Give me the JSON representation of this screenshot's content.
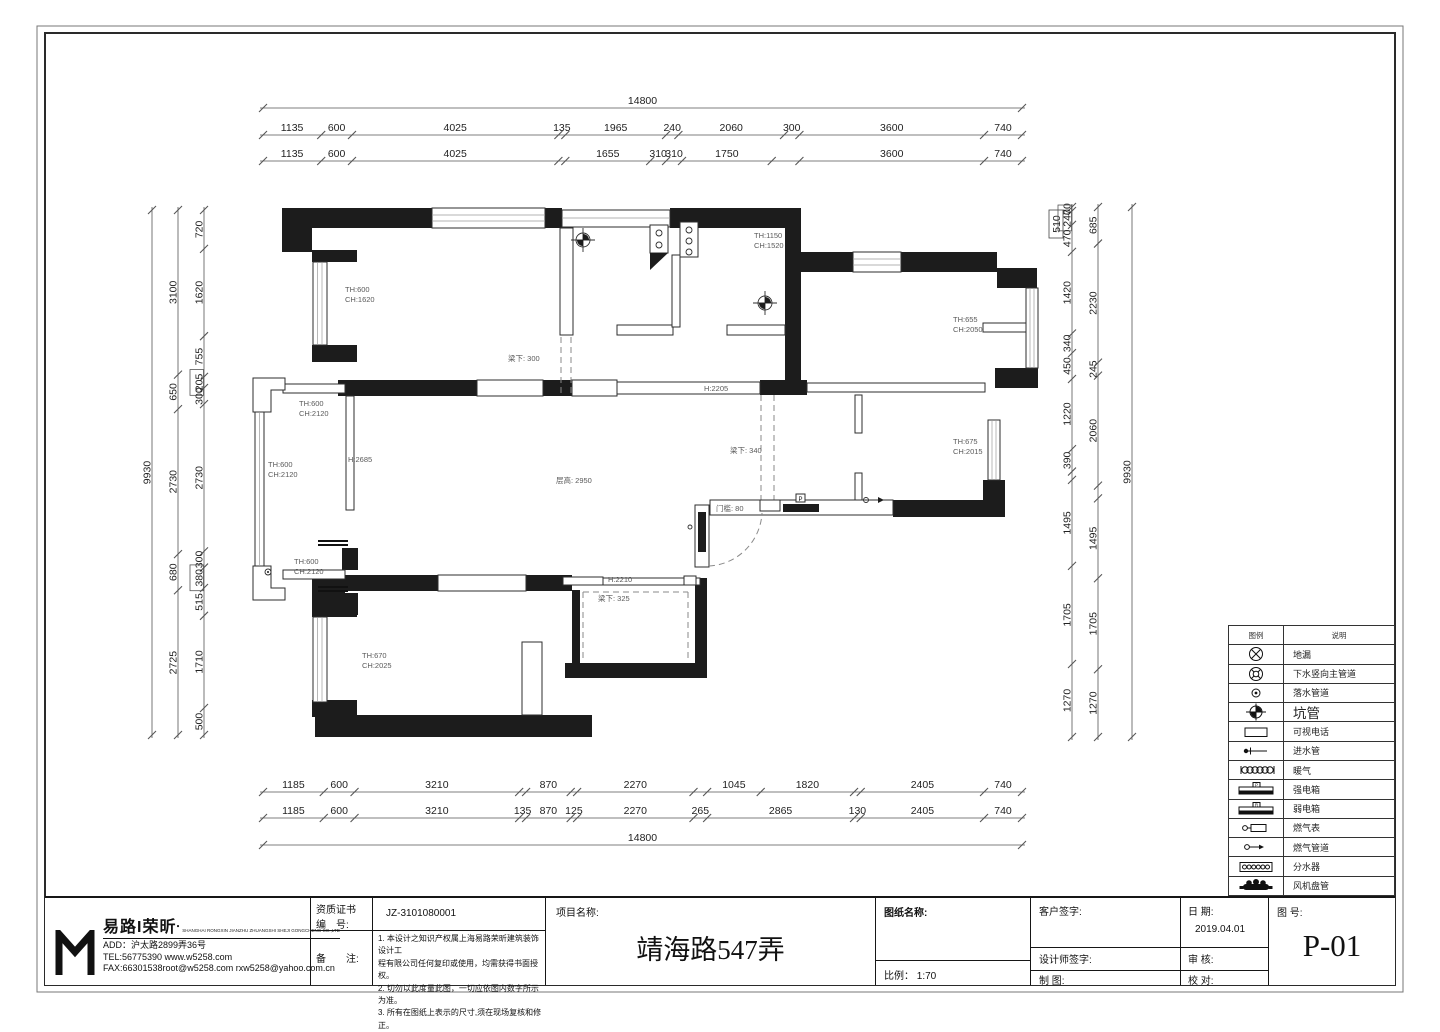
{
  "dims": {
    "top": {
      "total": [
        {
          "v": "14800",
          "s": 14800
        }
      ],
      "row2": [
        {
          "v": "1135",
          "s": 1135
        },
        {
          "v": "600",
          "s": 600
        },
        {
          "v": "4025",
          "s": 4025
        },
        {
          "v": "135",
          "s": 135
        },
        {
          "v": "1965",
          "s": 1965
        },
        {
          "v": "240",
          "s": 240
        },
        {
          "v": "2060",
          "s": 2060
        },
        {
          "v": "300",
          "s": 300
        },
        {
          "v": "3600",
          "s": 3600
        },
        {
          "v": "740",
          "s": 740
        }
      ],
      "row3": [
        {
          "v": "1135",
          "s": 1135
        },
        {
          "v": "600",
          "s": 600
        },
        {
          "v": "4025",
          "s": 4025
        },
        {
          "v": "",
          "s": 135
        },
        {
          "v": "1655",
          "s": 1655
        },
        {
          "v": "310",
          "s": 310
        },
        {
          "v": "310",
          "s": 310
        },
        {
          "v": "1750",
          "s": 1750
        },
        {
          "v": "",
          "s": 540
        },
        {
          "v": "3600",
          "s": 3600
        },
        {
          "v": "740",
          "s": 740
        }
      ]
    },
    "bottom": {
      "row1": [
        {
          "v": "1185",
          "s": 1185
        },
        {
          "v": "600",
          "s": 600
        },
        {
          "v": "3210",
          "s": 3210
        },
        {
          "v": "",
          "s": 135
        },
        {
          "v": "870",
          "s": 870
        },
        {
          "v": "",
          "s": 125
        },
        {
          "v": "2270",
          "s": 2270
        },
        {
          "v": "",
          "s": 265
        },
        {
          "v": "1045",
          "s": 1045
        },
        {
          "v": "1820",
          "s": 1820
        },
        {
          "v": "",
          "s": 130
        },
        {
          "v": "2405",
          "s": 2405
        },
        {
          "v": "740",
          "s": 740
        }
      ],
      "row2": [
        {
          "v": "1185",
          "s": 1185
        },
        {
          "v": "600",
          "s": 600
        },
        {
          "v": "3210",
          "s": 3210
        },
        {
          "v": "135",
          "s": 135
        },
        {
          "v": "870",
          "s": 870
        },
        {
          "v": "125",
          "s": 125
        },
        {
          "v": "2270",
          "s": 2270
        },
        {
          "v": "265",
          "s": 265
        },
        {
          "v": "2865",
          "s": 2865
        },
        {
          "v": "130",
          "s": 130
        },
        {
          "v": "2405",
          "s": 2405
        },
        {
          "v": "740",
          "s": 740
        }
      ],
      "total": [
        {
          "v": "14800",
          "s": 14800
        }
      ]
    },
    "left": {
      "inner": [
        {
          "v": "720",
          "s": 720
        },
        {
          "v": "1620",
          "s": 1620
        },
        {
          "v": "755",
          "s": 755
        },
        {
          "v": "205",
          "s": 205,
          "b": true
        },
        {
          "v": "300",
          "s": 300
        },
        {
          "v": "2730",
          "s": 2730
        },
        {
          "v": "300",
          "s": 300
        },
        {
          "v": "380",
          "s": 380,
          "b": true
        },
        {
          "v": "515",
          "s": 515
        },
        {
          "v": "1710",
          "s": 1710
        },
        {
          "v": "500",
          "s": 500
        }
      ],
      "middle": [
        {
          "v": "3100",
          "s": 3100
        },
        {
          "v": "650",
          "s": 650
        },
        {
          "v": "2730",
          "s": 2730
        },
        {
          "v": "680",
          "s": 680
        },
        {
          "v": "2725",
          "s": 2725
        }
      ],
      "total": [
        {
          "v": "9930",
          "s": 9930
        }
      ]
    },
    "right": {
      "inner": [
        {
          "v": "70",
          "s": 70
        },
        {
          "v": "240",
          "s": 240,
          "b": true
        },
        {
          "v": "470",
          "s": 470
        },
        {
          "v": "1420",
          "s": 1420
        },
        {
          "v": "340",
          "s": 340
        },
        {
          "v": "450",
          "s": 450
        },
        {
          "v": "1220",
          "s": 1220
        },
        {
          "v": "390",
          "s": 390
        },
        {
          "v": "",
          "s": 145
        },
        {
          "v": "1495",
          "s": 1495
        },
        {
          "v": "1705",
          "s": 1705
        },
        {
          "v": "1270",
          "s": 1270
        }
      ],
      "middle": [
        {
          "v": "685",
          "s": 685
        },
        {
          "v": "2230",
          "s": 2230
        },
        {
          "v": "245",
          "s": 245
        },
        {
          "v": "2060",
          "s": 2060
        },
        {
          "v": "",
          "s": 240
        },
        {
          "v": "1495",
          "s": 1495
        },
        {
          "v": "1705",
          "s": 1705
        },
        {
          "v": "1270",
          "s": 1270
        }
      ],
      "total": [
        {
          "v": "9930",
          "s": 9930
        }
      ],
      "note510": "510"
    }
  },
  "plan": {
    "labels": {
      "bed1_th": "TH:600",
      "bed1_ch": "CH:1620",
      "beam300": "梁下: 300",
      "kwin_th": "TH:1150",
      "kwin_ch": "CH:1520",
      "bed2_th": "TH:655",
      "bed2_ch": "CH:2050",
      "h2205": "H:2205",
      "balc_top_th": "TH:600",
      "balc_top_ch": "CH:2120",
      "balc_left_th": "TH:600",
      "balc_left_ch": "CH:2120",
      "balc_bot_th": "TH:600",
      "balc_bot_ch": "CH:2120",
      "h2685": "H:2685",
      "ceiling": "层高: 2950",
      "beam340": "梁下: 340",
      "sill80": "门槛: 80",
      "bath_th": "TH:675",
      "bath_ch": "CH:2015",
      "h2210": "H:2210",
      "beam325": "梁下: 325",
      "bed3_th": "TH:670",
      "bed3_ch": "CH:2025",
      "power_mark": "P"
    }
  },
  "legend": {
    "col_symbol": "图例",
    "col_desc": "说明",
    "rows": [
      {
        "icon": "floor-drain-icon",
        "label": "地漏"
      },
      {
        "icon": "main-drain-pipe-icon",
        "label": "下水竖向主管道"
      },
      {
        "icon": "downspout-icon",
        "label": "落水管道"
      },
      {
        "icon": "pit-pipe-icon",
        "label": "坑管"
      },
      {
        "icon": "video-phone-icon",
        "label": "可视电话"
      },
      {
        "icon": "water-inlet-icon",
        "label": "进水管"
      },
      {
        "icon": "radiator-icon",
        "label": "暖气"
      },
      {
        "icon": "power-box-icon",
        "label": "强电箱",
        "mark": "P"
      },
      {
        "icon": "weak-power-box-icon",
        "label": "弱电箱",
        "mark": "R"
      },
      {
        "icon": "gas-meter-icon",
        "label": "燃气表"
      },
      {
        "icon": "gas-pipe-icon",
        "label": "燃气管道"
      },
      {
        "icon": "manifold-icon",
        "label": "分水器"
      },
      {
        "icon": "fan-coil-icon",
        "label": "风机盘管"
      }
    ]
  },
  "titleblock": {
    "company": {
      "name": "易路I荣昕",
      "reg_mark": "●",
      "subtitle": "SHANGHAI RONGXIN JIANZHU ZHUANGSHI SHEJI GONGCHENG CO.,LTD",
      "address": "ADD：沪太路2899弄36号",
      "tel": "TEL:56775390  www.w5258.com",
      "fax": "FAX:66301538root@w5258.com  rxw5258@yahoo.com.cn"
    },
    "cert_label_1": "资质证书",
    "cert_label_2": "编　号:",
    "cert_value": "JZ-3101080001",
    "notes_label": "备　　注:",
    "notes": [
      "1.  本设计之知识产权属上海易路荣昕建筑装饰设计工",
      "程有限公司任何复印或使用，均需获得书面授权。",
      "2.  切勿以此度量此图，一切应依图内数字所示为准。",
      "3.  所有在图纸上表示的尺寸,须在现场复核和修正。"
    ],
    "project_label": "项目名称:",
    "project_name": "靖海路547弄",
    "drawing_name_label": "图纸名称:",
    "scale_label": "比例：  1:70",
    "client_sign_label": "客户签字:",
    "designer_sign_label": "设计师签字:",
    "draft_label": "制  图:",
    "date_label": "日  期:",
    "date_value": "2019.04.01",
    "review_label": "审  核:",
    "proof_label": "校  对:",
    "fig_no_label": "图  号:",
    "fig_no_value": "P-01"
  }
}
